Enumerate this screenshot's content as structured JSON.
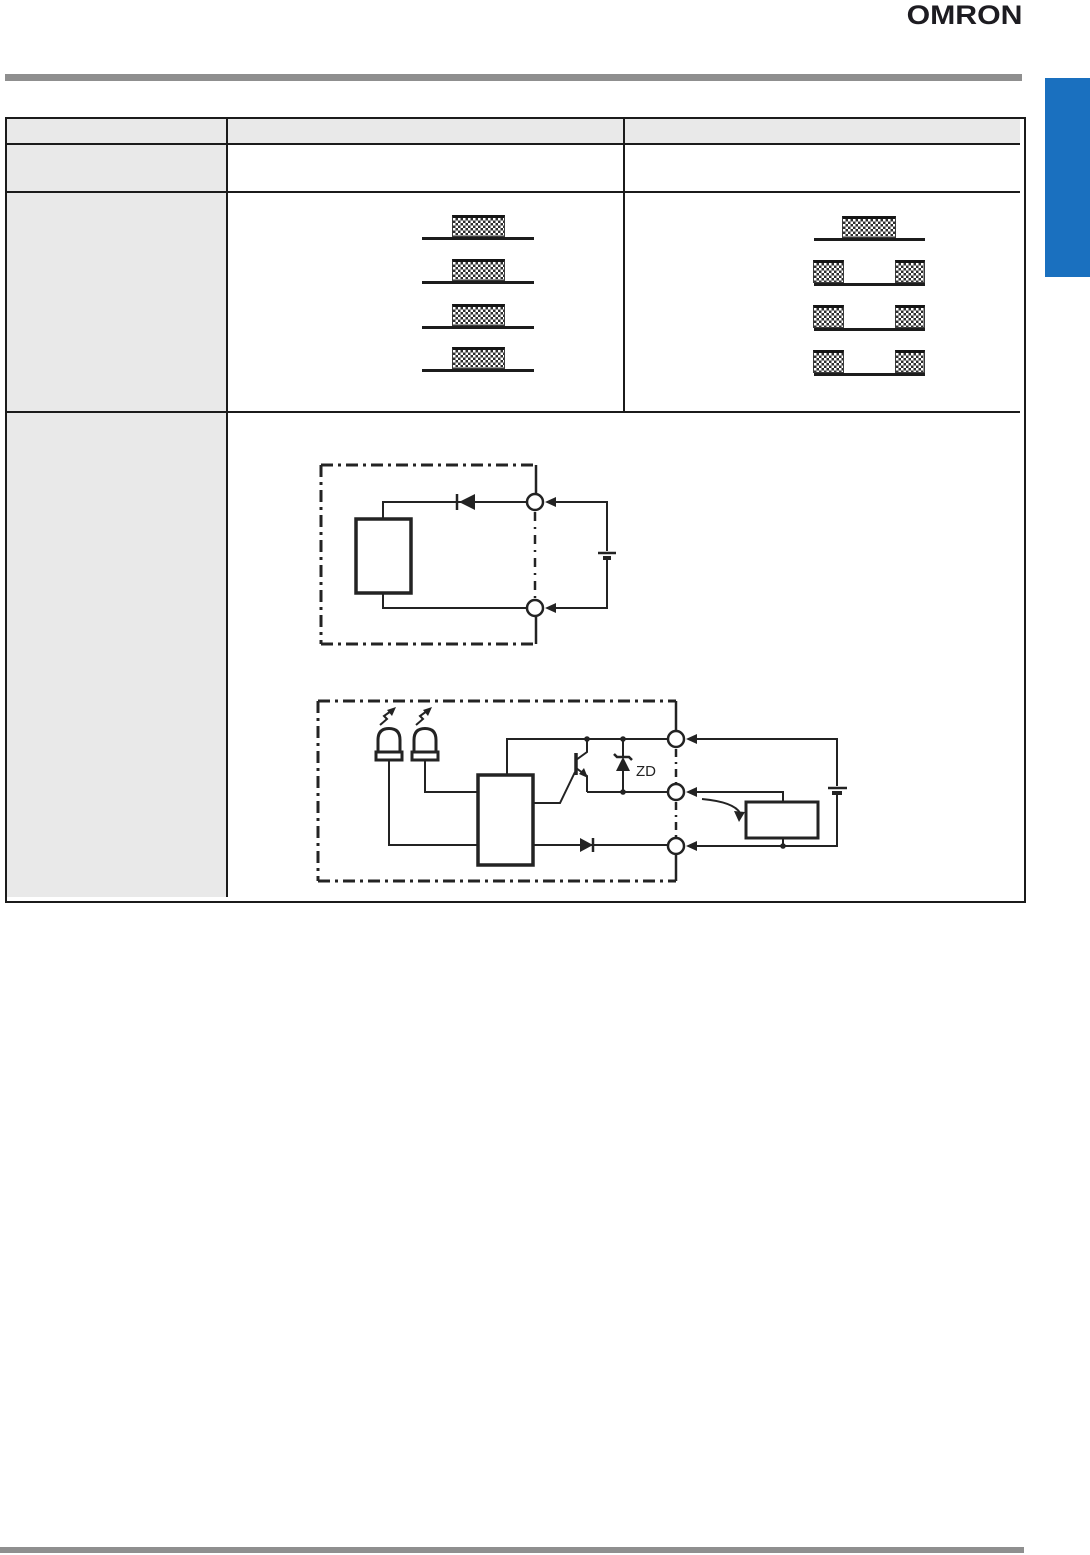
{
  "brand": {
    "logo_text": "OMRON"
  },
  "theme": {
    "accent_blue": "#1a70bf",
    "rule_gray": "#8f8f8f",
    "header_cell_bg": "#e9e9e9",
    "line_color": "#232323"
  },
  "spec_table": {
    "header_cells": [
      "",
      "",
      ""
    ],
    "row_label_cells": [
      "",
      "",
      ""
    ],
    "row2_cells": [
      "",
      ""
    ]
  },
  "timing_charts": {
    "left": {
      "type": "timing",
      "rows": [
        {
          "pattern": "center-pulse"
        },
        {
          "pattern": "center-pulse"
        },
        {
          "pattern": "center-pulse"
        },
        {
          "pattern": "center-pulse"
        }
      ]
    },
    "right": {
      "type": "timing",
      "rows": [
        {
          "pattern": "center-pulse"
        },
        {
          "pattern": "edge-pulses"
        },
        {
          "pattern": "edge-pulses"
        },
        {
          "pattern": "edge-pulses"
        }
      ]
    }
  },
  "circuit_diagrams": {
    "relay_output": {
      "components": [
        "internal-block",
        "diode",
        "terminal-top",
        "terminal-bottom",
        "battery"
      ]
    },
    "transistor_output": {
      "zener_label": "ZD",
      "components": [
        "indicator-led",
        "indicator-led",
        "main-circuit-block",
        "npn-transistor",
        "zener-diode",
        "diode",
        "terminal-top",
        "terminal-middle",
        "terminal-bottom",
        "battery",
        "load-block"
      ]
    }
  }
}
